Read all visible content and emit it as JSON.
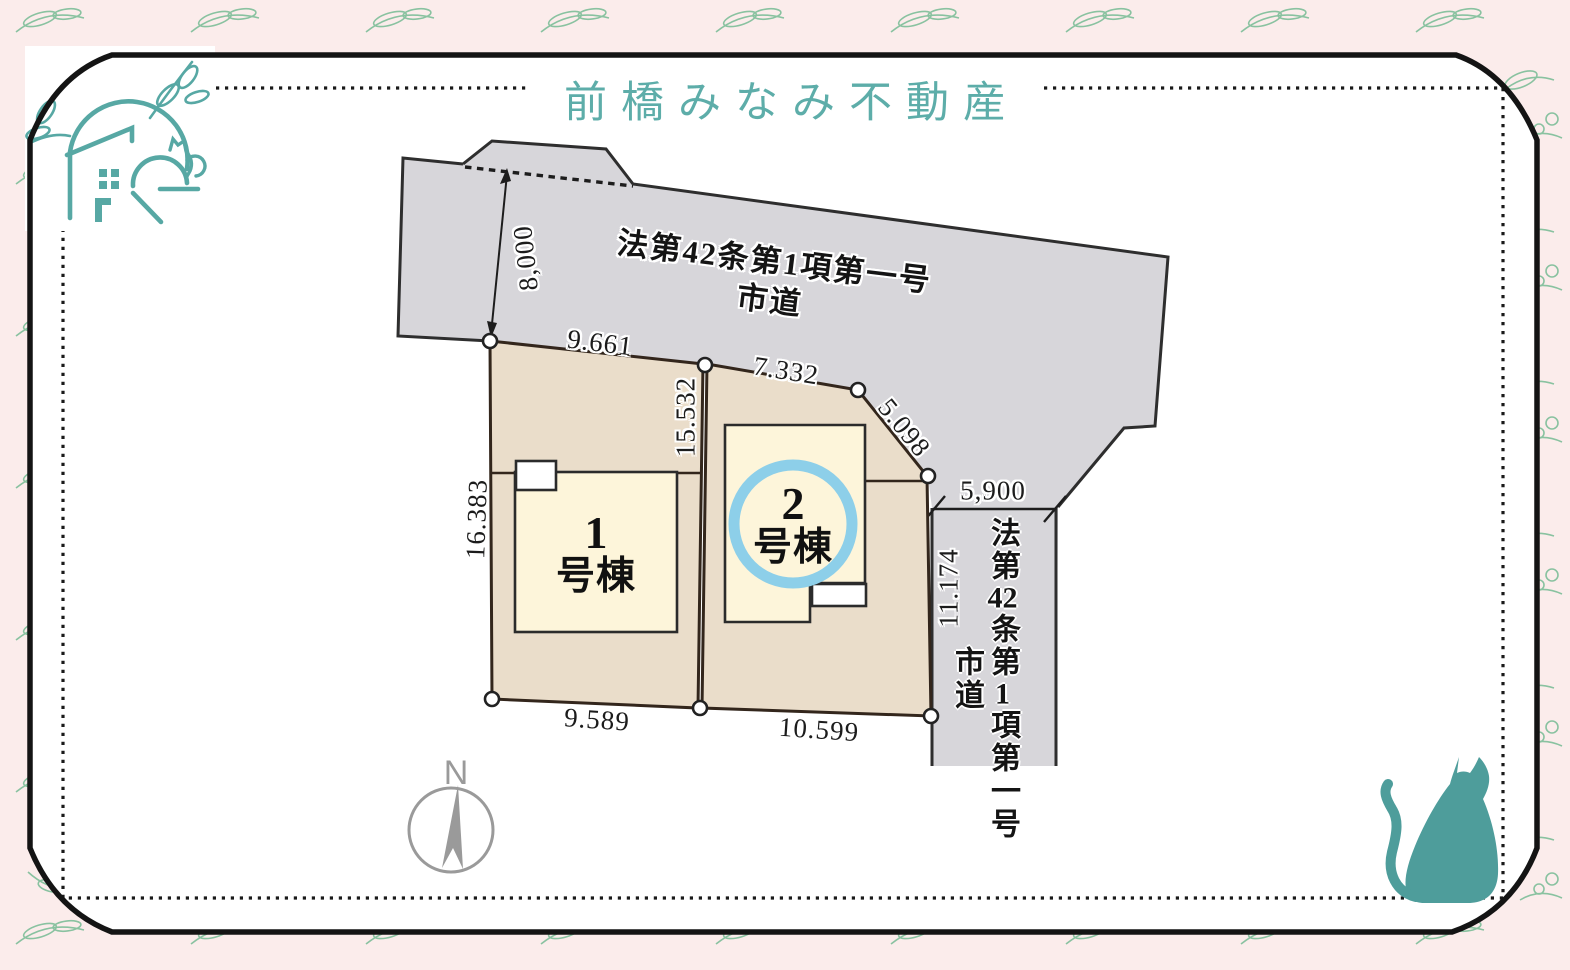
{
  "title": "前橋みなみ不動産",
  "roads": {
    "top": {
      "line1": "法第42条第1項第一号",
      "line2": "市道"
    },
    "right": {
      "p1": "法第",
      "num1": "42",
      "p2": "条第",
      "num2": "1",
      "p3": "項第一号",
      "line2": "市道"
    }
  },
  "buildings": {
    "b1": {
      "number": "1",
      "suffix": "号棟"
    },
    "b2": {
      "number": "2",
      "suffix": "号棟"
    }
  },
  "dimensions": {
    "top_road_width": "8,000",
    "plot1_top": "9.661",
    "plot2_top": "7.332",
    "plot2_corner": "5.098",
    "right_road_width": "5,900",
    "plot2_left": "15.532",
    "plot1_left": "16.383",
    "plot2_right": "11.174",
    "plot1_bottom": "9.589",
    "plot2_bottom": "10.599"
  },
  "compass": {
    "north": "N"
  },
  "colors": {
    "accent_teal": "#57a8a4",
    "cat_teal": "#4e9d9b",
    "road_gray": "#d7d6da",
    "plot_tan": "#eaddca",
    "building_cream": "#fdf5da",
    "highlight_blue": "#8dcfe9",
    "background_pink": "#fbeceb",
    "floral_green": "#79bd97",
    "line_dark": "#2b241e"
  }
}
